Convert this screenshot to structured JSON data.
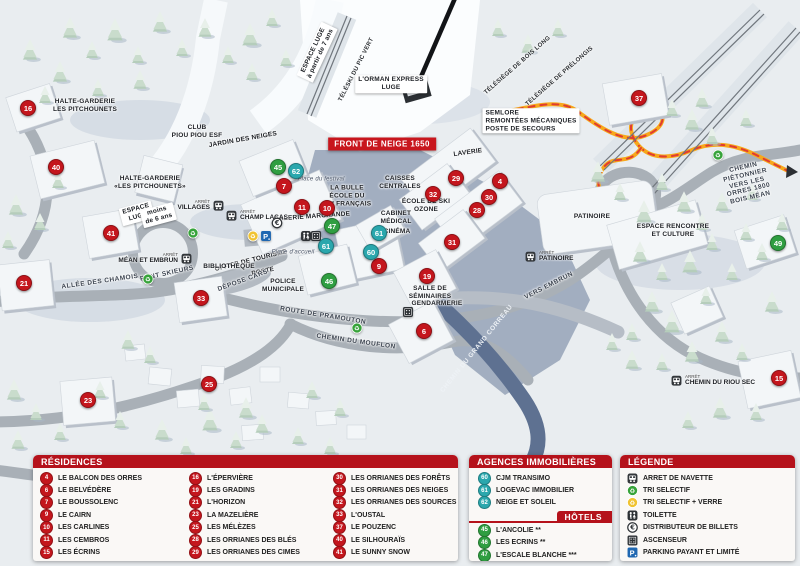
{
  "map": {
    "banner": "FRONT DE NEIGE 1650",
    "stop_word": "ARRÊT",
    "labels": [
      {
        "text": "ESPACE LUGE\nà partir de 7 ans",
        "x": 317,
        "y": 52,
        "rot": -65,
        "cls": "box"
      },
      {
        "text": "TÉLÉSKI DU PIC VERT",
        "x": 357,
        "y": 70,
        "rot": -63,
        "cls": "lift"
      },
      {
        "text": "L'ORMAN EXPRESS\nLUGE",
        "x": 391,
        "y": 84,
        "rot": 0,
        "cls": "box"
      },
      {
        "text": "TÉLÉSIÈGE DE BOIS LONG",
        "x": 518,
        "y": 66,
        "rot": -41,
        "cls": "lift"
      },
      {
        "text": "TÉLÉSIÈGE DE PRÉLONGIS",
        "x": 560,
        "y": 77,
        "rot": -41,
        "cls": "lift"
      },
      {
        "text": "SEMLORE\nREMONTÉES MÉCANIQUES\nPOSTE DE SECOURS",
        "x": 531,
        "y": 121,
        "rot": 0,
        "cls": "box left"
      },
      {
        "text": "HALTE-GARDERIE\nLES PITCHOUNETS",
        "x": 85,
        "y": 106,
        "rot": 0,
        "cls": ""
      },
      {
        "text": "CLUB\nPIOU PIOU ESF",
        "x": 197,
        "y": 132,
        "rot": 0,
        "cls": ""
      },
      {
        "text": "JARDIN DES NEIGES",
        "x": 243,
        "y": 140,
        "rot": -10,
        "cls": ""
      },
      {
        "text": "HALTE-GARDERIE\n«LES PITCHOUNETS»",
        "x": 150,
        "y": 183,
        "rot": 0,
        "cls": ""
      },
      {
        "text": "ESPACE\nLUGE",
        "x": 137,
        "y": 213,
        "rot": -15,
        "cls": "box"
      },
      {
        "text": "moins\nde 6 ans",
        "x": 158,
        "y": 215,
        "rot": -15,
        "cls": "box"
      },
      {
        "text": "LAVERIE",
        "x": 468,
        "y": 153,
        "rot": -8,
        "cls": ""
      },
      {
        "text": "CAISSES\nCENTRALES",
        "x": 400,
        "y": 183,
        "rot": 0,
        "cls": ""
      },
      {
        "text": "Place du festival",
        "x": 321,
        "y": 180,
        "rot": 0,
        "cls": "it"
      },
      {
        "text": "LA BULLE\nÉCOLE DU\nSKI FRANÇAIS",
        "x": 347,
        "y": 196,
        "rot": 0,
        "cls": ""
      },
      {
        "text": "GALERIE MARCHANDE",
        "x": 312,
        "y": 217,
        "rot": -4,
        "cls": ""
      },
      {
        "text": "ÉCOLE DE SKI\nOZONE",
        "x": 426,
        "y": 206,
        "rot": 0,
        "cls": ""
      },
      {
        "text": "CABINET\nMÉDICAL",
        "x": 396,
        "y": 218,
        "rot": 0,
        "cls": ""
      },
      {
        "text": "CINÉMA",
        "x": 397,
        "y": 232,
        "rot": 0,
        "cls": ""
      },
      {
        "text": "OFFICE DE TOURISME",
        "x": 251,
        "y": 261,
        "rot": -14,
        "cls": ""
      },
      {
        "text": "BIBLIOTHÈQUE",
        "x": 229,
        "y": 267,
        "rot": 0,
        "cls": ""
      },
      {
        "text": "POSTE",
        "x": 263,
        "y": 272,
        "rot": -12,
        "cls": ""
      },
      {
        "text": "POLICE\nMUNICIPALE",
        "x": 283,
        "y": 286,
        "rot": 0,
        "cls": ""
      },
      {
        "text": "DÉPOSE CARS",
        "x": 243,
        "y": 281,
        "rot": -20,
        "cls": "rd"
      },
      {
        "text": "Place d'accueil",
        "x": 293,
        "y": 253,
        "rot": 0,
        "cls": "it"
      },
      {
        "text": "SALLE DE\nSÉMINAIRES",
        "x": 430,
        "y": 293,
        "rot": 0,
        "cls": ""
      },
      {
        "text": "GENDARMERIE",
        "x": 437,
        "y": 304,
        "rot": 0,
        "cls": ""
      },
      {
        "text": "PATINOIRE",
        "x": 592,
        "y": 217,
        "rot": 0,
        "cls": ""
      },
      {
        "text": "ESPACE RENCONTRE\nET CULTURE",
        "x": 673,
        "y": 231,
        "rot": 0,
        "cls": ""
      },
      {
        "text": "ALLÉE DES CHAMOIS",
        "x": 100,
        "y": 282,
        "rot": -8,
        "cls": "rd"
      },
      {
        "text": "PONT SKIEURS",
        "x": 167,
        "y": 274,
        "rot": -12,
        "cls": "rd"
      },
      {
        "text": "ROUTE DE PRAMOUTON",
        "x": 323,
        "y": 316,
        "rot": 9,
        "cls": "rd"
      },
      {
        "text": "CHEMIN DU MOUFLON",
        "x": 356,
        "y": 342,
        "rot": 8,
        "cls": "rd"
      },
      {
        "text": "CHEMIN DU GRAND CORREAU",
        "x": 477,
        "y": 349,
        "rot": -51,
        "cls": "rw"
      },
      {
        "text": "VERS EMBRUN",
        "x": 549,
        "y": 286,
        "rot": -27,
        "cls": "rd"
      },
      {
        "text": "CHEMIN PIÉTONNIER\nVERS LES ORRES 1800\nBOIS MÉAN",
        "x": 747,
        "y": 183,
        "rot": -13,
        "cls": "rd"
      }
    ],
    "markers": [
      {
        "n": 16,
        "x": 28,
        "y": 108,
        "k": "res"
      },
      {
        "n": 40,
        "x": 56,
        "y": 167,
        "k": "res"
      },
      {
        "n": 41,
        "x": 111,
        "y": 233,
        "k": "res"
      },
      {
        "n": 21,
        "x": 24,
        "y": 283,
        "k": "res"
      },
      {
        "n": 33,
        "x": 201,
        "y": 298,
        "k": "res"
      },
      {
        "n": 23,
        "x": 88,
        "y": 400,
        "k": "res"
      },
      {
        "n": 25,
        "x": 209,
        "y": 384,
        "k": "res"
      },
      {
        "n": 7,
        "x": 284,
        "y": 186,
        "k": "res"
      },
      {
        "n": 11,
        "x": 302,
        "y": 207,
        "k": "res"
      },
      {
        "n": 10,
        "x": 327,
        "y": 208,
        "k": "res"
      },
      {
        "n": 9,
        "x": 379,
        "y": 266,
        "k": "res"
      },
      {
        "n": 29,
        "x": 456,
        "y": 178,
        "k": "res"
      },
      {
        "n": 4,
        "x": 500,
        "y": 181,
        "k": "res"
      },
      {
        "n": 32,
        "x": 433,
        "y": 194,
        "k": "res"
      },
      {
        "n": 30,
        "x": 489,
        "y": 197,
        "k": "res"
      },
      {
        "n": 28,
        "x": 477,
        "y": 210,
        "k": "res"
      },
      {
        "n": 31,
        "x": 452,
        "y": 242,
        "k": "res"
      },
      {
        "n": 19,
        "x": 427,
        "y": 276,
        "k": "res"
      },
      {
        "n": 6,
        "x": 424,
        "y": 331,
        "k": "res"
      },
      {
        "n": 37,
        "x": 639,
        "y": 98,
        "k": "res"
      },
      {
        "n": 15,
        "x": 779,
        "y": 378,
        "k": "res"
      },
      {
        "n": 62,
        "x": 296,
        "y": 171,
        "k": "agency"
      },
      {
        "n": 61,
        "x": 326,
        "y": 246,
        "k": "agency"
      },
      {
        "n": 61,
        "x": 379,
        "y": 233,
        "k": "agency"
      },
      {
        "n": 60,
        "x": 371,
        "y": 252,
        "k": "agency"
      },
      {
        "n": 45,
        "x": 278,
        "y": 167,
        "k": "hotel"
      },
      {
        "n": 47,
        "x": 332,
        "y": 226,
        "k": "hotel"
      },
      {
        "n": 46,
        "x": 329,
        "y": 281,
        "k": "hotel"
      },
      {
        "n": 49,
        "x": 778,
        "y": 243,
        "k": "hotel"
      }
    ],
    "icons": [
      {
        "t": "recycle-green",
        "x": 193,
        "y": 233
      },
      {
        "t": "recycle-green",
        "x": 148,
        "y": 279
      },
      {
        "t": "recycle-green",
        "x": 718,
        "y": 155
      },
      {
        "t": "recycle-green",
        "x": 357,
        "y": 328
      },
      {
        "t": "recycle-yellow",
        "x": 253,
        "y": 236
      },
      {
        "t": "parking",
        "x": 266,
        "y": 236
      },
      {
        "t": "euro",
        "x": 277,
        "y": 223
      },
      {
        "t": "toilet",
        "x": 306,
        "y": 236
      },
      {
        "t": "elevator",
        "x": 316,
        "y": 236
      },
      {
        "t": "elevator",
        "x": 408,
        "y": 312
      }
    ],
    "bus_stops": [
      {
        "name": "VILLAGES",
        "x": 218,
        "y": 206,
        "side": "left"
      },
      {
        "name": "CHAMP LACAS",
        "x": 232,
        "y": 216,
        "side": "right"
      },
      {
        "name": "MÉAN ET EMBRUN",
        "x": 186,
        "y": 259,
        "side": "left"
      },
      {
        "name": "PATINOIRE",
        "x": 531,
        "y": 257,
        "side": "right"
      },
      {
        "name": "CHEMIN DU RIOU SEC",
        "x": 677,
        "y": 381,
        "side": "right"
      }
    ]
  },
  "panels": {
    "residences": {
      "title": "RÉSIDENCES",
      "columns": [
        [
          {
            "n": 4,
            "label": "LE BALCON DES ORRES"
          },
          {
            "n": 6,
            "label": "LE BELVÉDÈRE"
          },
          {
            "n": 7,
            "label": "LE BOUSSOLENC"
          },
          {
            "n": 9,
            "label": "LE CAIRN"
          },
          {
            "n": 10,
            "label": "LES CARLINES"
          },
          {
            "n": 11,
            "label": "LES CEMBROS"
          },
          {
            "n": 15,
            "label": "LES ÉCRINS"
          }
        ],
        [
          {
            "n": 16,
            "label": "L'ÉPERVIÈRE"
          },
          {
            "n": 19,
            "label": "LES GRADINS"
          },
          {
            "n": 21,
            "label": "L'HORIZON"
          },
          {
            "n": 23,
            "label": "LA MAZELIÈRE"
          },
          {
            "n": 25,
            "label": "LES MÉLÈZES"
          },
          {
            "n": 28,
            "label": "LES ORRIANES DES BLÉS"
          },
          {
            "n": 29,
            "label": "LES ORRIANES DES CIMES"
          }
        ],
        [
          {
            "n": 30,
            "label": "LES ORRIANES DES FORÊTS"
          },
          {
            "n": 31,
            "label": "LES ORRIANES DES NEIGES"
          },
          {
            "n": 32,
            "label": "LES ORRIANES DES SOURCES"
          },
          {
            "n": 33,
            "label": "L'OUSTAL"
          },
          {
            "n": 37,
            "label": "LE POUZENC"
          },
          {
            "n": 40,
            "label": "LE SILHOURAÏS"
          },
          {
            "n": 41,
            "label": "LE SUNNY SNOW"
          }
        ]
      ]
    },
    "agences": {
      "title": "AGENCES IMMOBILIÈRES",
      "items": [
        {
          "n": 60,
          "label": "CJM TRANSIMO"
        },
        {
          "n": 61,
          "label": "LOGEVAC IMMOBILIER"
        },
        {
          "n": 62,
          "label": "NEIGE ET SOLEIL"
        }
      ]
    },
    "hotels": {
      "title": "HÔTELS",
      "items": [
        {
          "n": 45,
          "label": "L'ANCOLIE **"
        },
        {
          "n": 46,
          "label": "LES ECRINS **"
        },
        {
          "n": 47,
          "label": "L'ESCALE BLANCHE ***"
        },
        {
          "n": 49,
          "label": "LES TRAPPEURS **"
        }
      ]
    },
    "legende": {
      "title": "LÉGENDE",
      "items": [
        {
          "icon": "bus",
          "label": "ARRET DE NAVETTE"
        },
        {
          "icon": "recycle-green",
          "label": "TRI SELECTIF"
        },
        {
          "icon": "recycle-yellow",
          "label": "TRI SELECTIF + VERRE"
        },
        {
          "icon": "toilet",
          "label": "TOILETTE"
        },
        {
          "icon": "euro",
          "label": "DISTRIBUTEUR DE BILLETS"
        },
        {
          "icon": "elevator",
          "label": "ASCENSEUR"
        },
        {
          "icon": "parking",
          "label": "PARKING PAYANT ET LIMITÉ"
        }
      ]
    }
  },
  "colors": {
    "residence": "#c4161d",
    "agency": "#2aa7ad",
    "hotel": "#2f9e41",
    "header_red": "#b5121b",
    "banner_red": "#c8161d",
    "parking_blue": "#1f67b1",
    "recycle_green": "#37a33a",
    "recycle_yellow": "#f0c331",
    "path_orange": "#f7a81b"
  }
}
